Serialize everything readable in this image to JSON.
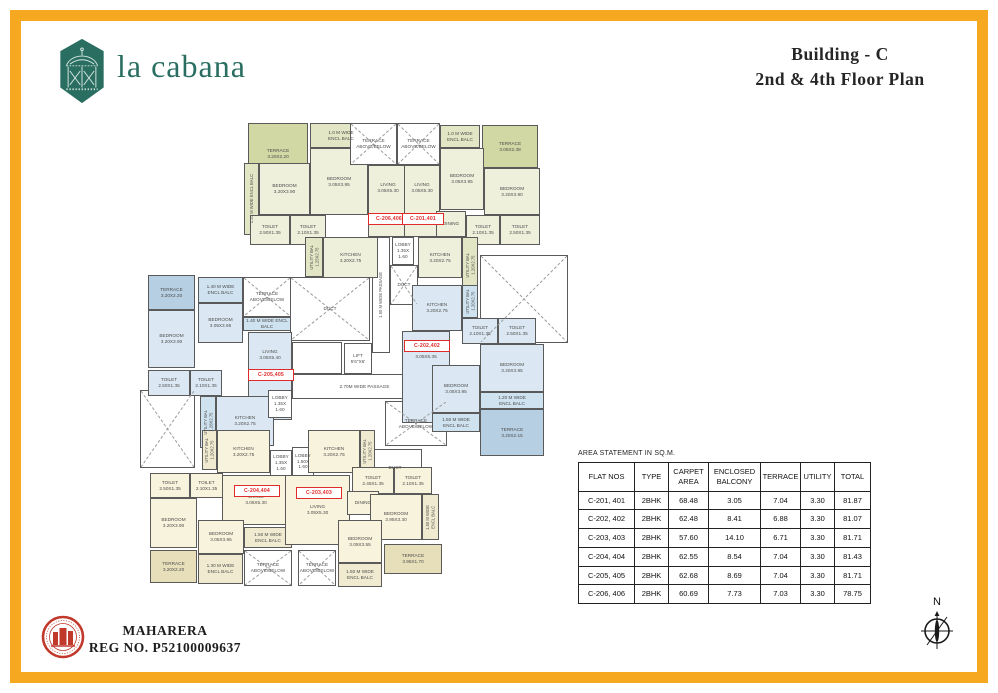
{
  "page": {
    "brand": "la cabana",
    "title_line1": "Building - C",
    "title_line2": "2nd & 4th Floor Plan",
    "rera_line1": "MAHARERA",
    "rera_line2": "REG NO. P52100009637",
    "north_label": "N",
    "accent_color": "#F6A821",
    "brand_color": "#2A6E62"
  },
  "area_table": {
    "title": "AREA STATEMENT IN SQ.M.",
    "headers": [
      "FLAT NOS",
      "TYPE",
      "CARPET\nAREA",
      "ENCLOSED\nBALCONY",
      "TERRACE",
      "UTILITY",
      "TOTAL"
    ],
    "rows": [
      [
        "C-201, 401",
        "2BHK",
        "68.48",
        "3.05",
        "7.04",
        "3.30",
        "81.87"
      ],
      [
        "C-202, 402",
        "2BHK",
        "62.48",
        "8.41",
        "6.88",
        "3.30",
        "81.07"
      ],
      [
        "C-203, 403",
        "2BHK",
        "57.60",
        "14.10",
        "6.71",
        "3.30",
        "81.71"
      ],
      [
        "C-204, 404",
        "2BHK",
        "62.55",
        "8.54",
        "7.04",
        "3.30",
        "81.43"
      ],
      [
        "C-205, 405",
        "2BHK",
        "62.68",
        "8.69",
        "7.04",
        "3.30",
        "81.71"
      ],
      [
        "C-206, 406",
        "2BHK",
        "60.69",
        "7.73",
        "7.03",
        "3.30",
        "78.75"
      ]
    ]
  },
  "floorplan": {
    "colors": {
      "o1": "#eef0dc",
      "o2": "#d2d8a4",
      "o3": "#e3e6c4",
      "b1": "#dbe8f3",
      "b2": "#b6cfe2",
      "b3": "#cfe2f0",
      "c1": "#f8f3dc",
      "c2": "#e7dfba",
      "c3": "#f0ebd0",
      "w": "#ffffff"
    },
    "rooms": [
      {
        "n": "passage-1-50",
        "t": "1.50 M WIDE PASSAGE",
        "x": 232,
        "y": 124,
        "w": 18,
        "h": 116,
        "f": "w",
        "o": "v"
      },
      {
        "n": "duct-top",
        "t": "DUCT",
        "x": 250,
        "y": 152,
        "w": 28,
        "h": 40,
        "f": "w",
        "xm": true
      },
      {
        "n": "duct-main",
        "t": "DUCT",
        "x": 150,
        "y": 164,
        "w": 80,
        "h": 64,
        "f": "w",
        "xm": true
      },
      {
        "n": "staircase",
        "t": "",
        "x": 152,
        "y": 229,
        "w": 50,
        "h": 32,
        "f": "w",
        "st": true
      },
      {
        "n": "lift",
        "t": "LIFT\n5'6\"X6'",
        "x": 204,
        "y": 230,
        "w": 28,
        "h": 31,
        "f": "w"
      },
      {
        "n": "passage-2-70",
        "t": "2.70M WIDE PASSAGE",
        "x": 152,
        "y": 261,
        "w": 145,
        "h": 25,
        "f": "w"
      },
      {
        "n": "terrace-above-below-mid",
        "t": "TERRACE\nABOVE/BELOW",
        "x": 245,
        "y": 288,
        "w": 62,
        "h": 45,
        "f": "w",
        "xm": true
      },
      {
        "n": "duct-bottom",
        "t": "DUCT",
        "x": 228,
        "y": 336,
        "w": 54,
        "h": 38,
        "f": "w"
      },
      {
        "n": "void-right",
        "t": "",
        "x": 340,
        "y": 142,
        "w": 88,
        "h": 88,
        "f": "w",
        "xm": true
      },
      {
        "n": "void-left",
        "t": "",
        "x": 0,
        "y": 277,
        "w": 55,
        "h": 78,
        "f": "w",
        "xm": true
      },
      {
        "n": "c206-terrace",
        "t": "TERRACE\n3.20X2.20",
        "x": 108,
        "y": 10,
        "w": 60,
        "h": 62,
        "f": "o2"
      },
      {
        "n": "c206-encl-balc-top",
        "t": "1.0 M WIDE\nENCL BALC",
        "x": 170,
        "y": 10,
        "w": 62,
        "h": 25,
        "f": "o3"
      },
      {
        "n": "c206-bedroom-1",
        "t": "BEDROOM\n3.05X3.95",
        "x": 170,
        "y": 35,
        "w": 58,
        "h": 67,
        "f": "o1"
      },
      {
        "n": "c206-encl-balc-left",
        "t": "1.20 M WIDE ENCL BALC",
        "x": 104,
        "y": 50,
        "w": 15,
        "h": 72,
        "f": "o3",
        "o": "v"
      },
      {
        "n": "c206-bedroom-2",
        "t": "BEDROOM\n3.20X3.90",
        "x": 119,
        "y": 50,
        "w": 51,
        "h": 52,
        "f": "o1"
      },
      {
        "n": "c206-toilet-1",
        "t": "TOILET\n2.50X1.35",
        "x": 110,
        "y": 102,
        "w": 40,
        "h": 30,
        "f": "o1"
      },
      {
        "n": "c206-toilet-2",
        "t": "TOILET\n2.10X1.35",
        "x": 150,
        "y": 102,
        "w": 36,
        "h": 30,
        "f": "o1"
      },
      {
        "n": "c206-living",
        "t": "LIVING\n3.05X5.30",
        "x": 228,
        "y": 52,
        "w": 40,
        "h": 72,
        "f": "o1",
        "va": "t"
      },
      {
        "n": "c206-kitchen",
        "t": "KITCHEN\n3.20X2.75",
        "x": 183,
        "y": 124,
        "w": 55,
        "h": 41,
        "f": "o1"
      },
      {
        "n": "c206-utility-bal",
        "t": "UTILITY BAL\n1.25X2.75",
        "x": 165,
        "y": 124,
        "w": 18,
        "h": 40,
        "f": "o3",
        "o": "v"
      },
      {
        "n": "c206-lobby",
        "t": "LOBBY\n1.35X\n1.60",
        "x": 252,
        "y": 124,
        "w": 22,
        "h": 28,
        "f": "w"
      },
      {
        "n": "terrace-above-below-1",
        "t": "TERRACE\nABOVE/BELOW",
        "x": 210,
        "y": 10,
        "w": 47,
        "h": 42,
        "f": "w",
        "xm": true
      },
      {
        "n": "terrace-above-below-2",
        "t": "TERRACE\nABOVE/BELOW",
        "x": 257,
        "y": 10,
        "w": 43,
        "h": 42,
        "f": "w",
        "xm": true
      },
      {
        "n": "c201-encl-balc-top",
        "t": "1.0 M WIDE\nENCL BALC",
        "x": 300,
        "y": 12,
        "w": 40,
        "h": 23,
        "f": "o3"
      },
      {
        "n": "c201-terrace",
        "t": "TERRACE\n3.05X2.38",
        "x": 342,
        "y": 12,
        "w": 56,
        "h": 43,
        "f": "o2"
      },
      {
        "n": "c201-bedroom-1",
        "t": "BEDROOM\n3.05X3.95",
        "x": 300,
        "y": 35,
        "w": 44,
        "h": 62,
        "f": "o1"
      },
      {
        "n": "c201-bedroom-2",
        "t": "BEDROOM\n3.20X3.90",
        "x": 344,
        "y": 55,
        "w": 56,
        "h": 47,
        "f": "o1"
      },
      {
        "n": "c201-living",
        "t": "LIVING\n3.05X5.30",
        "x": 264,
        "y": 52,
        "w": 36,
        "h": 72,
        "f": "o1",
        "va": "t"
      },
      {
        "n": "c201-dining",
        "t": "DINING",
        "x": 296,
        "y": 98,
        "w": 30,
        "h": 26,
        "f": "o1"
      },
      {
        "n": "c201-toilet-1",
        "t": "TOILET\n2.10X1.35",
        "x": 326,
        "y": 102,
        "w": 34,
        "h": 30,
        "f": "o1"
      },
      {
        "n": "c201-toilet-2",
        "t": "TOILET\n2.50X1.35",
        "x": 360,
        "y": 102,
        "w": 40,
        "h": 30,
        "f": "o1"
      },
      {
        "n": "c201-kitchen",
        "t": "KITCHEN\n3.20X2.75",
        "x": 278,
        "y": 124,
        "w": 44,
        "h": 41,
        "f": "o1"
      },
      {
        "n": "c201-utility-bal",
        "t": "UTILITY BAL\n1.20X2.75",
        "x": 322,
        "y": 124,
        "w": 16,
        "h": 56,
        "f": "o3",
        "o": "v"
      },
      {
        "n": "c205-terrace",
        "t": "TERRACE\n3.20X2.20",
        "x": 8,
        "y": 162,
        "w": 47,
        "h": 35,
        "f": "b2"
      },
      {
        "n": "c205-encl-balc-1",
        "t": "1.40 M WIDE\nENCL BALC",
        "x": 58,
        "y": 164,
        "w": 45,
        "h": 26,
        "f": "b3"
      },
      {
        "n": "c205-bedroom-1",
        "t": "BEDROOM\n3.05X3.95",
        "x": 58,
        "y": 190,
        "w": 45,
        "h": 40,
        "f": "b1"
      },
      {
        "n": "c205-terrace-above-below",
        "t": "TERRACE\nABOVE/BELOW",
        "x": 103,
        "y": 164,
        "w": 48,
        "h": 40,
        "f": "w",
        "xm": true
      },
      {
        "n": "c205-encl-balc-2",
        "t": "1.40 M WIDE ENCL BALC",
        "x": 103,
        "y": 204,
        "w": 48,
        "h": 14,
        "f": "b3"
      },
      {
        "n": "c205-bedroom-2",
        "t": "BEDROOM\n3.20X3.90",
        "x": 8,
        "y": 197,
        "w": 47,
        "h": 58,
        "f": "b1"
      },
      {
        "n": "c205-living",
        "t": "LIVING\n3.05X5.40",
        "x": 108,
        "y": 219,
        "w": 44,
        "h": 88,
        "f": "b1",
        "va": "t"
      },
      {
        "n": "c205-toilet-1",
        "t": "TOILET\n2.50X1.35",
        "x": 8,
        "y": 257,
        "w": 42,
        "h": 26,
        "f": "b1"
      },
      {
        "n": "c205-toilet-2",
        "t": "TOILET\n2.10X1.35",
        "x": 50,
        "y": 257,
        "w": 32,
        "h": 26,
        "f": "b1"
      },
      {
        "n": "c205-utility-bal",
        "t": "UTILITY BAL\n1.28X2.75",
        "x": 60,
        "y": 283,
        "w": 16,
        "h": 52,
        "f": "b3",
        "o": "v"
      },
      {
        "n": "c205-kitchen",
        "t": "KITCHEN\n3.20X2.75",
        "x": 76,
        "y": 283,
        "w": 58,
        "h": 50,
        "f": "b1"
      },
      {
        "n": "c205-lobby",
        "t": "LOBBY\n1.35X\n1.60",
        "x": 128,
        "y": 277,
        "w": 24,
        "h": 28,
        "f": "w"
      },
      {
        "n": "c202-kitchen",
        "t": "KITCHEN\n3.20X2.75",
        "x": 272,
        "y": 172,
        "w": 50,
        "h": 46,
        "f": "b1"
      },
      {
        "n": "c202-utility-bal",
        "t": "UTILITY BAL\n1.20X2.75",
        "x": 322,
        "y": 172,
        "w": 16,
        "h": 33,
        "f": "b3",
        "o": "v"
      },
      {
        "n": "c202-toilet-1",
        "t": "TOILET\n2.10X1.35",
        "x": 322,
        "y": 205,
        "w": 36,
        "h": 26,
        "f": "b1"
      },
      {
        "n": "c202-toilet-2",
        "t": "TOILET\n2.50X1.35",
        "x": 358,
        "y": 205,
        "w": 38,
        "h": 26,
        "f": "b1"
      },
      {
        "n": "c202-living",
        "t": "LIVING\n3.05X5.35",
        "x": 262,
        "y": 218,
        "w": 48,
        "h": 92,
        "f": "b1",
        "va": "t"
      },
      {
        "n": "c202-bedroom-1",
        "t": "BEDROOM\n3.20X3.95",
        "x": 340,
        "y": 231,
        "w": 64,
        "h": 48,
        "f": "b1"
      },
      {
        "n": "c202-encl-balc-1",
        "t": "1.20 M WIDE\nENCL BALC",
        "x": 340,
        "y": 279,
        "w": 64,
        "h": 17,
        "f": "b3"
      },
      {
        "n": "c202-bedroom-2",
        "t": "BEDROOM\n3.05X3.95",
        "x": 292,
        "y": 252,
        "w": 48,
        "h": 48,
        "f": "b1"
      },
      {
        "n": "c202-encl-balc-2",
        "t": "1.50 M WIDE\nENCL BALC",
        "x": 292,
        "y": 300,
        "w": 48,
        "h": 19,
        "f": "b3"
      },
      {
        "n": "c202-terrace",
        "t": "TERRACE\n3.20X2.15",
        "x": 340,
        "y": 296,
        "w": 64,
        "h": 47,
        "f": "b2"
      },
      {
        "n": "c204-utility-bal",
        "t": "UTILITY BAL\n1.20X2.75",
        "x": 62,
        "y": 317,
        "w": 15,
        "h": 40,
        "f": "c3",
        "o": "v"
      },
      {
        "n": "c204-kitchen",
        "t": "KITCHEN\n3.20X2.75",
        "x": 77,
        "y": 317,
        "w": 53,
        "h": 43,
        "f": "c1"
      },
      {
        "n": "c204-lobby-1",
        "t": "LOBBY\n1.35X\n1.60",
        "x": 130,
        "y": 337,
        "w": 22,
        "h": 26,
        "f": "w"
      },
      {
        "n": "c203-lobby",
        "t": "LOBBY\n1.50X\n1.60",
        "x": 152,
        "y": 334,
        "w": 22,
        "h": 29,
        "f": "w"
      },
      {
        "n": "c204-toilet-1",
        "t": "TOILET\n2.50X1.35",
        "x": 10,
        "y": 360,
        "w": 40,
        "h": 25,
        "f": "c1"
      },
      {
        "n": "c204-toilet-2",
        "t": "TOILET\n2.10X1.35",
        "x": 50,
        "y": 360,
        "w": 33,
        "h": 25,
        "f": "c1"
      },
      {
        "n": "c204-bedroom-1",
        "t": "BEDROOM\n3.20X3.90",
        "x": 10,
        "y": 385,
        "w": 47,
        "h": 50,
        "f": "c1"
      },
      {
        "n": "c204-living",
        "t": "LIVING\n3.05X5.30",
        "x": 82,
        "y": 362,
        "w": 68,
        "h": 50,
        "f": "c1"
      },
      {
        "n": "c204-bedroom-2",
        "t": "BEDROOM\n3.05X3.95",
        "x": 58,
        "y": 407,
        "w": 46,
        "h": 34,
        "f": "c1"
      },
      {
        "n": "c204-encl-balc-1",
        "t": "1.50 M WIDE\nENCL BALC",
        "x": 104,
        "y": 414,
        "w": 48,
        "h": 21,
        "f": "c3"
      },
      {
        "n": "c204-terrace",
        "t": "TERRACE\n3.20X2.20",
        "x": 10,
        "y": 437,
        "w": 47,
        "h": 33,
        "f": "c2"
      },
      {
        "n": "c204-encl-balc-2",
        "t": "1.30 M WIDE\nENCL BALC",
        "x": 58,
        "y": 441,
        "w": 45,
        "h": 30,
        "f": "c3"
      },
      {
        "n": "c204-terrace-above-below",
        "t": "TERRACE\nABOVE/BELOW",
        "x": 104,
        "y": 437,
        "w": 48,
        "h": 36,
        "f": "w",
        "xm": true
      },
      {
        "n": "c203-kitchen",
        "t": "KITCHEN\n3.20X2.75",
        "x": 168,
        "y": 317,
        "w": 52,
        "h": 43,
        "f": "c1"
      },
      {
        "n": "c203-utility-bal",
        "t": "UTILITY BAL\n1.20X2.75",
        "x": 220,
        "y": 317,
        "w": 15,
        "h": 43,
        "f": "c3",
        "o": "v"
      },
      {
        "n": "c203-toilet-1",
        "t": "TOILET\n2.45X1.35",
        "x": 212,
        "y": 354,
        "w": 42,
        "h": 27,
        "f": "c1"
      },
      {
        "n": "c203-toilet-2",
        "t": "TOILET\n2.10X1.35",
        "x": 254,
        "y": 354,
        "w": 38,
        "h": 27,
        "f": "c1"
      },
      {
        "n": "c203-living",
        "t": "LIVING\n3.05X5.30",
        "x": 145,
        "y": 362,
        "w": 65,
        "h": 70,
        "f": "c1"
      },
      {
        "n": "c203-dining",
        "t": "DINING",
        "x": 207,
        "y": 378,
        "w": 32,
        "h": 24,
        "f": "c1"
      },
      {
        "n": "c203-bedroom-1",
        "t": "BEDROOM\n3.95X3.30",
        "x": 230,
        "y": 381,
        "w": 52,
        "h": 46,
        "f": "c1"
      },
      {
        "n": "c203-encl-balc-1",
        "t": "1.50 M WIDE\nENCL BALC",
        "x": 282,
        "y": 381,
        "w": 17,
        "h": 46,
        "f": "c3",
        "o": "v"
      },
      {
        "n": "c203-bedroom-2",
        "t": "BEDROOM\n3.05X3.55",
        "x": 198,
        "y": 407,
        "w": 44,
        "h": 43,
        "f": "c1"
      },
      {
        "n": "c203-terrace",
        "t": "TERRACE\n3.95X1.70",
        "x": 244,
        "y": 431,
        "w": 58,
        "h": 30,
        "f": "c2"
      },
      {
        "n": "c203-encl-balc-2",
        "t": "1.50 M WIDE\nENCL BALC",
        "x": 198,
        "y": 450,
        "w": 44,
        "h": 24,
        "f": "c3"
      },
      {
        "n": "c203-terrace-above-below",
        "t": "TERRACE\nABOVE/BELOW",
        "x": 158,
        "y": 437,
        "w": 38,
        "h": 36,
        "f": "w",
        "xm": true
      }
    ],
    "unit_labels": [
      {
        "n": "unit-label-c206",
        "text": "C-206,406",
        "x": 228,
        "y": 100,
        "w": 40
      },
      {
        "n": "unit-label-c201",
        "text": "C-201,401",
        "x": 262,
        "y": 100,
        "w": 40
      },
      {
        "n": "unit-label-c205",
        "text": "C-205,405",
        "x": 108,
        "y": 256,
        "w": 44
      },
      {
        "n": "unit-label-c202",
        "text": "C-202,402",
        "x": 264,
        "y": 227,
        "w": 44
      },
      {
        "n": "unit-label-c204",
        "text": "C-204,404",
        "x": 94,
        "y": 372,
        "w": 44
      },
      {
        "n": "unit-label-c203",
        "text": "C-203,403",
        "x": 156,
        "y": 374,
        "w": 44
      }
    ]
  }
}
